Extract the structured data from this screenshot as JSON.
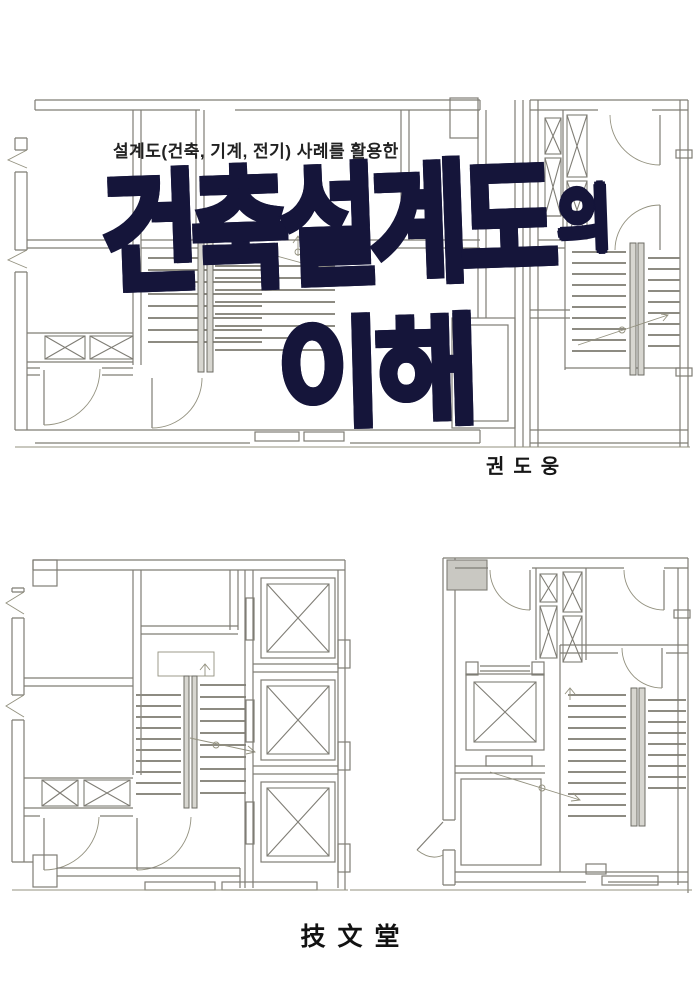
{
  "cover": {
    "subtitle": "설계도(건축, 기계, 전기) 사례를 활용한",
    "title_line1": "건축설계도",
    "title_particle": "의",
    "title_line2": "이해",
    "title_full": "건축설계도의 이해",
    "author": "권도웅",
    "publisher": "技文堂",
    "colors": {
      "title_ink": "#15153a",
      "plan_line": "#7f7d75",
      "text": "#1c1c1c",
      "paper": "#ffffff"
    },
    "drawings": [
      {
        "name": "floor-plan-top-left",
        "kind": "hand-drawn architectural floor plan with stair, shafts and door swings"
      },
      {
        "name": "floor-plan-top-right",
        "kind": "hand-drawn floor plan with duct shafts and stair"
      },
      {
        "name": "floor-plan-bottom-left",
        "kind": "hand-drawn floor plan with three elevator shafts and stair"
      },
      {
        "name": "floor-plan-bottom-right",
        "kind": "hand-drawn floor plan with elevator, shafts and stair"
      }
    ]
  }
}
